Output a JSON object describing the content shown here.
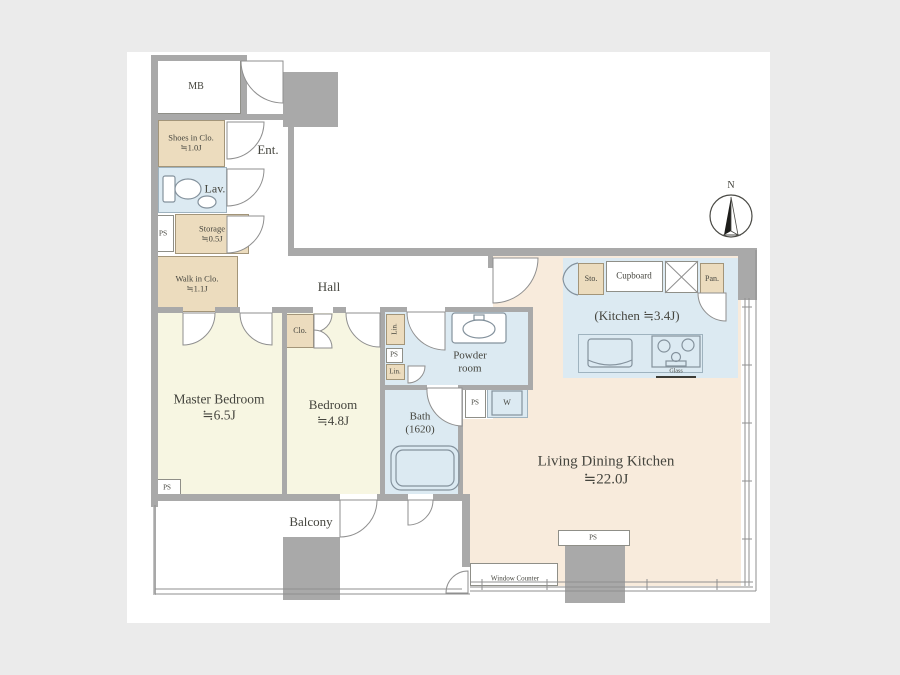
{
  "page": {
    "background": "#ebebeb",
    "canvas": "#ffffff"
  },
  "colors": {
    "wall": "#a9a9a9",
    "bedroom_fill": "#f7f6e2",
    "living_fill": "#f8ebdc",
    "wet_area_fill": "#dceaf2",
    "closet_fill": "#ecdcbe",
    "text": "#45453e"
  },
  "compass": {
    "north_label": "N"
  },
  "rooms": {
    "meter_box": {
      "label": "MB"
    },
    "entrance": {
      "label": "Ent."
    },
    "shoes_closet": {
      "label": "Shoes in Clo.",
      "size": "≒1.0J"
    },
    "lavatory": {
      "label": "Lav."
    },
    "pipe_space_1": {
      "label": "PS"
    },
    "storage": {
      "label": "Storage",
      "size": "≒0.5J"
    },
    "walk_in_closet": {
      "label": "Walk in Clo.",
      "size": "≒1.1J"
    },
    "hall": {
      "label": "Hall"
    },
    "master_bedroom": {
      "label": "Master Bedroom",
      "size": "≒6.5J"
    },
    "bedroom": {
      "label": "Bedroom",
      "size": "≒4.8J"
    },
    "closet": {
      "label": "Clo."
    },
    "linen_1": {
      "label": "Lin."
    },
    "pipe_space_2": {
      "label": "PS"
    },
    "linen_2": {
      "label": "Lin."
    },
    "powder_room": {
      "label": "Powder room"
    },
    "bath": {
      "label": "Bath",
      "size": "(1620)"
    },
    "pipe_space_3": {
      "label": "PS"
    },
    "washer": {
      "label": "W"
    },
    "kitchen_storage": {
      "label": "Sto."
    },
    "cupboard": {
      "label": "Cupboard"
    },
    "pantry": {
      "label": "Pan."
    },
    "kitchen": {
      "label": "(Kitchen ≒3.4J)"
    },
    "stove_note": {
      "label": "Glass"
    },
    "living_dining_kitchen": {
      "label": "Living Dining Kitchen",
      "size": "≒22.0J"
    },
    "balcony": {
      "label": "Balcony"
    },
    "window_counter": {
      "label": "Window Counter"
    },
    "pipe_space_4": {
      "label": "PS"
    },
    "pipe_space_5": {
      "label": "PS"
    }
  }
}
